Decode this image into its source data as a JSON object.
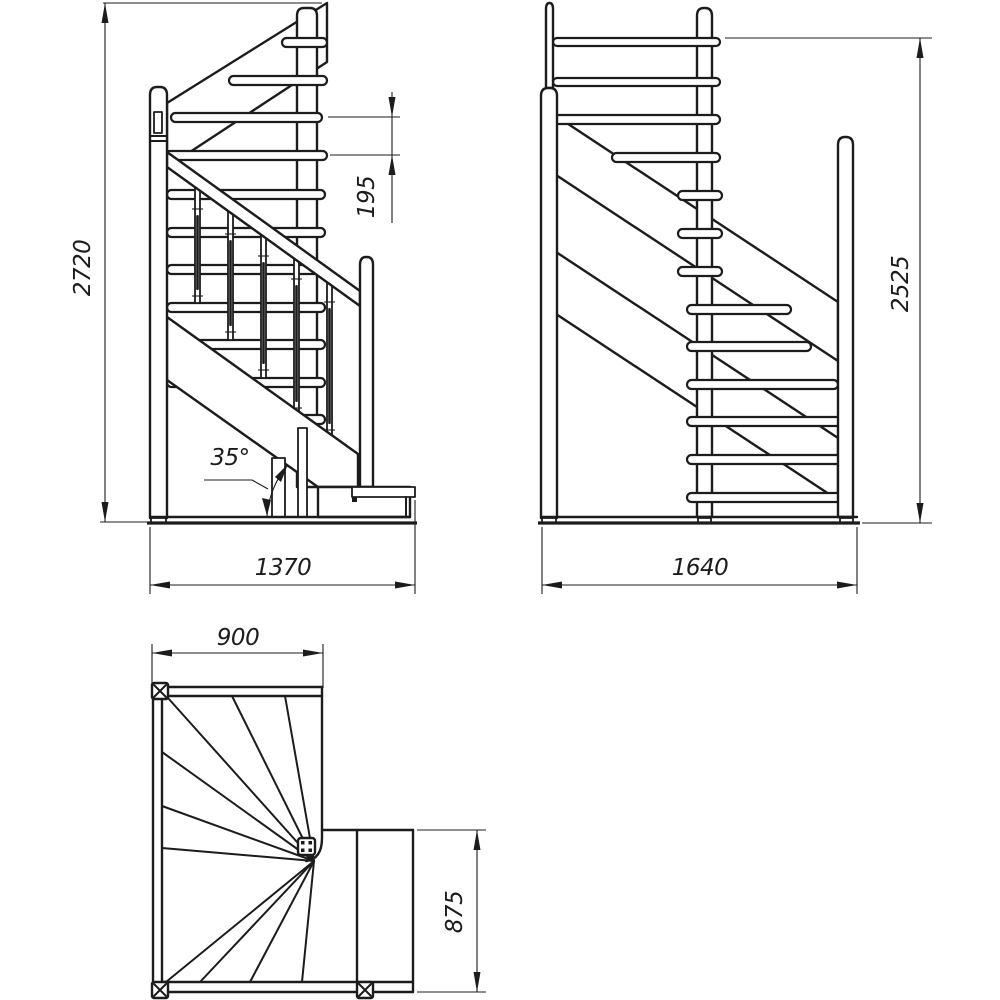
{
  "drawing": {
    "type": "staircase technical drawing",
    "colors": {
      "ink": "#1c1c1c",
      "paper": "#ffffff"
    },
    "views": {
      "front": {
        "label": "front elevation",
        "dim_height": "2720",
        "dim_riser": "195",
        "dim_width": "1370",
        "dim_angle": "35°"
      },
      "side": {
        "label": "side elevation",
        "dim_height": "2525",
        "dim_width": "1640"
      },
      "plan": {
        "label": "plan view",
        "dim_width": "900",
        "dim_depth": "875"
      }
    }
  }
}
